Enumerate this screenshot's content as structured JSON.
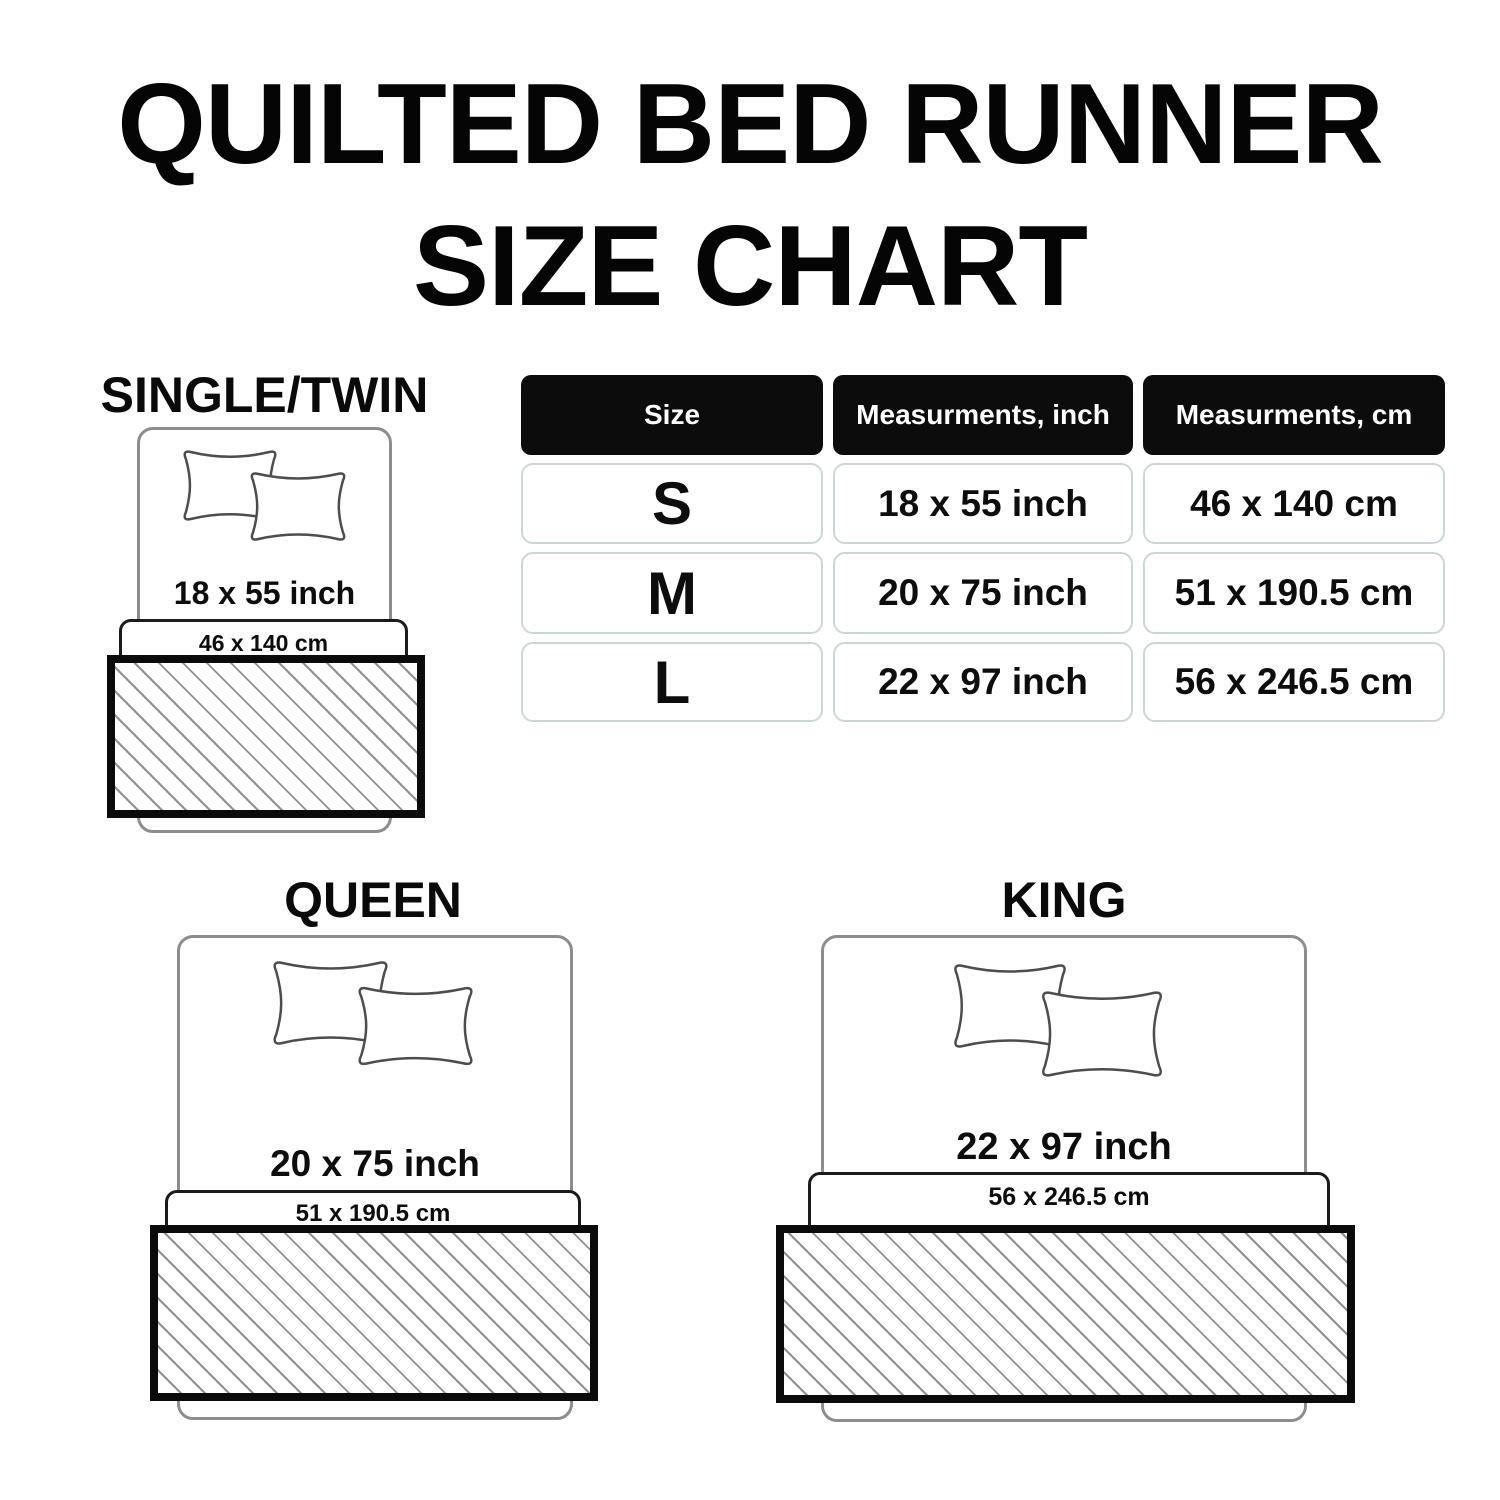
{
  "title": {
    "line1": "QUILTED BED RUNNER",
    "line2": "SIZE CHART"
  },
  "table": {
    "headers": {
      "size": "Size",
      "inch": "Measurments, inch",
      "cm": "Measurments, cm"
    },
    "rows": [
      {
        "size": "S",
        "inch": "18 x 55 inch",
        "cm": "46 x 140 cm"
      },
      {
        "size": "M",
        "inch": "20 x 75 inch",
        "cm": "51 x 190.5 cm"
      },
      {
        "size": "L",
        "inch": "22 x 97 inch",
        "cm": "56 x 246.5 cm"
      }
    ]
  },
  "diagrams": {
    "single": {
      "label": "SINGLE/TWIN",
      "inch": "18 x 55 inch",
      "cm": "46 x 140 cm"
    },
    "queen": {
      "label": "QUEEN",
      "inch": "20 x 75 inch",
      "cm": "51 x 190.5 cm"
    },
    "king": {
      "label": "KING",
      "inch": "22 x 97 inch",
      "cm": "56 x 246.5 cm"
    }
  },
  "colors": {
    "text": "#111111",
    "table_header_bg": "#0c0c0c",
    "table_header_text": "#ffffff",
    "table_cell_border": "#ccd6d9",
    "bed_outline": "#8d8d8d",
    "pillow_outline": "#4d4d4d",
    "runner_border": "#0b0b0b",
    "hatch_line": "#8f8f8f"
  }
}
